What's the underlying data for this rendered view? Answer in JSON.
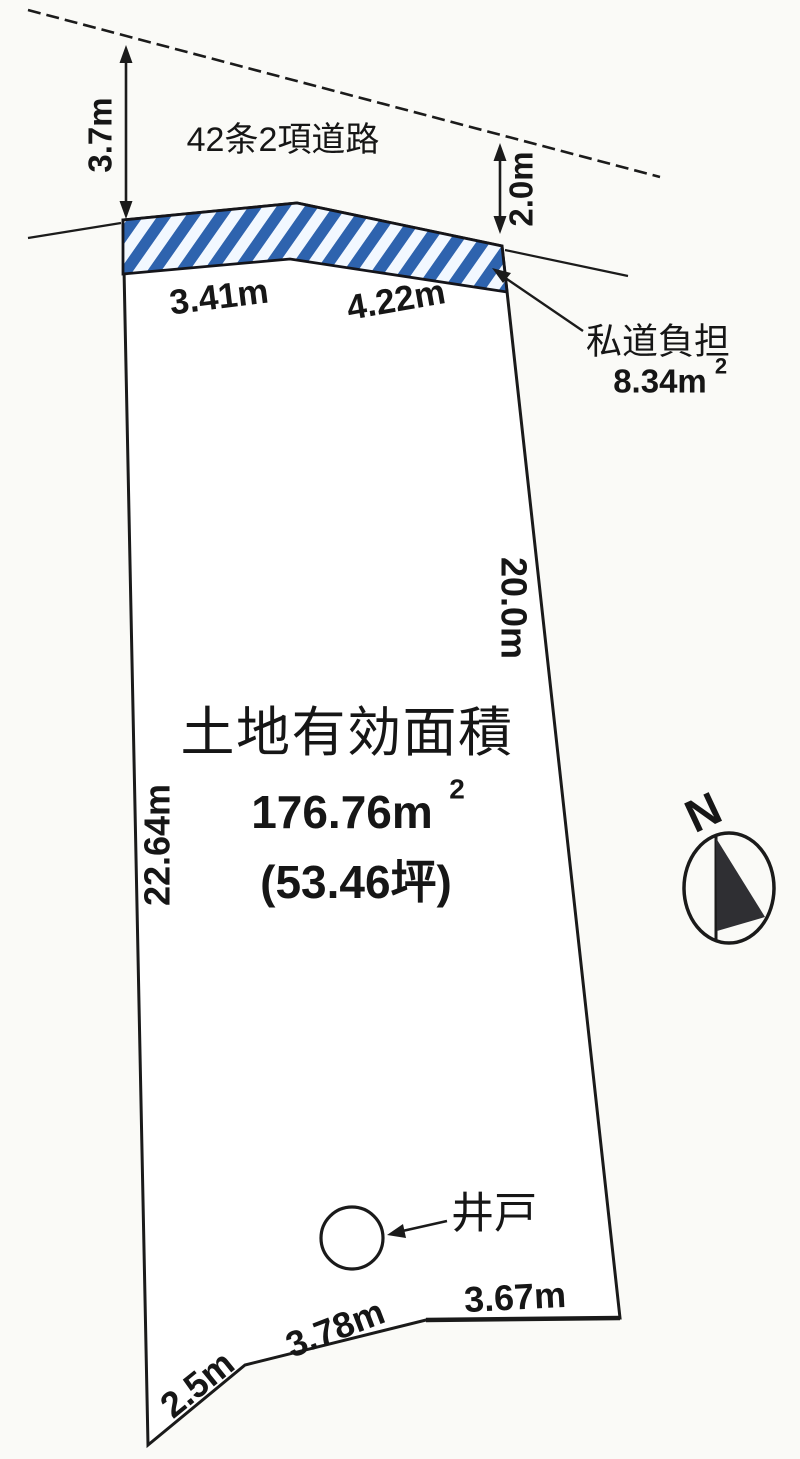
{
  "diagram": {
    "road": {
      "name": "42条2項道路",
      "front_width": "3.7m",
      "side_width": "2.0m"
    },
    "private_road": {
      "label": "私道負担",
      "area_value": "8.34m",
      "area_sup": "2",
      "edge_left": "3.41m",
      "edge_right": "4.22m"
    },
    "parcel": {
      "title": "土地有効面積",
      "area_value": "176.76m",
      "area_sup": "2",
      "area_tsubo": "(53.46坪)",
      "side_west": "22.64m",
      "side_east": "20.0m",
      "bottom_right": "3.67m",
      "bottom_middle": "3.78m",
      "bottom_left": "2.5m"
    },
    "well": {
      "label": "井戸"
    },
    "compass": {
      "label": "N"
    },
    "colors": {
      "hatch_blue": "#2e63ae",
      "hatch_bg": "#f2f8ff",
      "ink": "#1b1b1b",
      "paper": "#fafaf7"
    }
  }
}
